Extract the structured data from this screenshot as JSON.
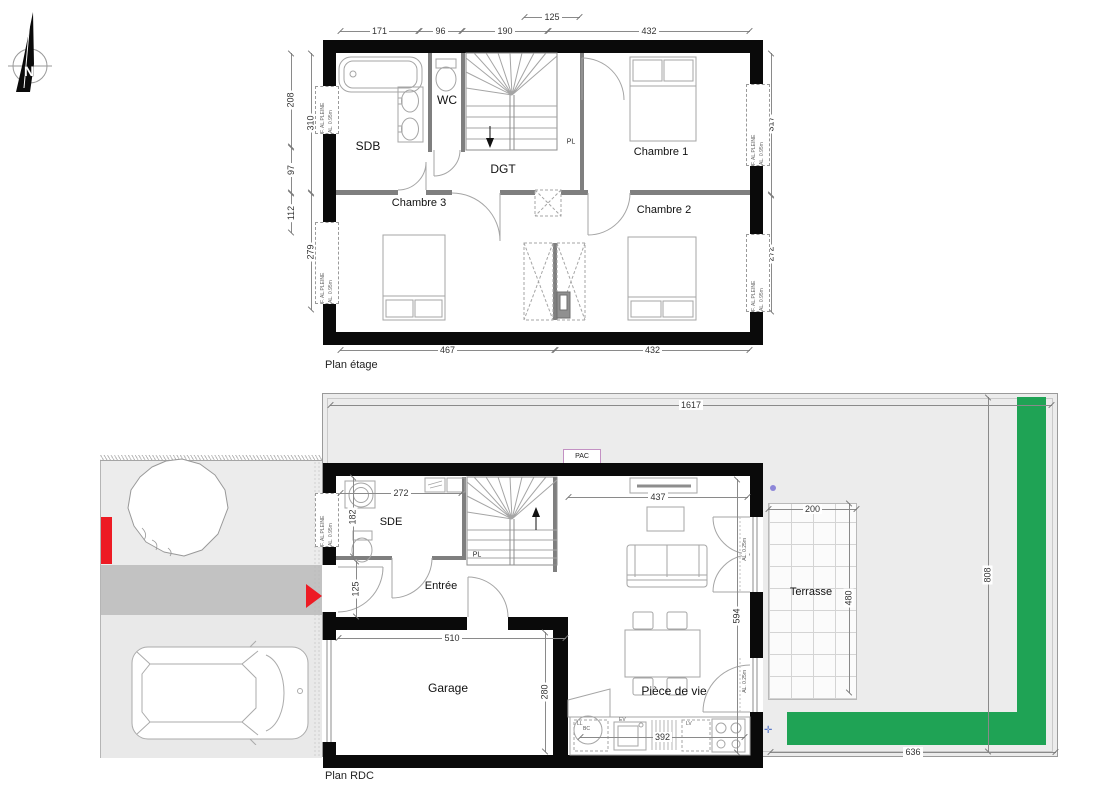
{
  "app": {
    "type": "architectural-floorplan"
  },
  "compass": {
    "letter": "N"
  },
  "colors": {
    "wall": "#0a0a0a",
    "hedge_green": "#1fa355",
    "accent_red": "#ed1b24",
    "driveway_gray": "#c2c2c2",
    "garden_gray": "#ececec"
  },
  "floor1": {
    "title": "Plan étage",
    "rooms": {
      "sdb": "SDB",
      "wc": "WC",
      "dgt": "DGT",
      "chambre1": "Chambre 1",
      "chambre2": "Chambre 2",
      "chambre3": "Chambre 3",
      "placard": "PL"
    },
    "dims": {
      "d171": "171",
      "d96": "96",
      "d190": "190",
      "d125": "125",
      "d432_top": "432",
      "d208": "208",
      "d97": "97",
      "d112": "112",
      "d310": "310",
      "d279": "279",
      "d317": "317",
      "d272": "272",
      "d467": "467",
      "d432_bottom": "432"
    },
    "window": {
      "type_label": "F. AL.PLEINE",
      "sill_label": "AL. 0.95m"
    }
  },
  "floor0": {
    "title": "Plan RDC",
    "rooms": {
      "sde": "SDE",
      "entree": "Entrée",
      "garage": "Garage",
      "piece_de_vie": "Pièce de vie",
      "terrasse": "Terrasse",
      "placard": "PL"
    },
    "dims": {
      "d1617": "1617",
      "d808": "808",
      "d636": "636",
      "d200": "200",
      "d480": "480",
      "d272": "272",
      "d182": "182",
      "d125": "125",
      "d510": "510",
      "d280": "280",
      "d594": "594",
      "d437": "437",
      "d392": "392"
    },
    "labels": {
      "pac": "PAC",
      "ll": "LL",
      "ev": "EV",
      "lv": "LV",
      "bc": "BC",
      "bay_sill": "AL. 0.25m"
    },
    "window": {
      "type_label": "F. AL.PLEINE",
      "sill_label": "AL. 0.95m"
    }
  }
}
